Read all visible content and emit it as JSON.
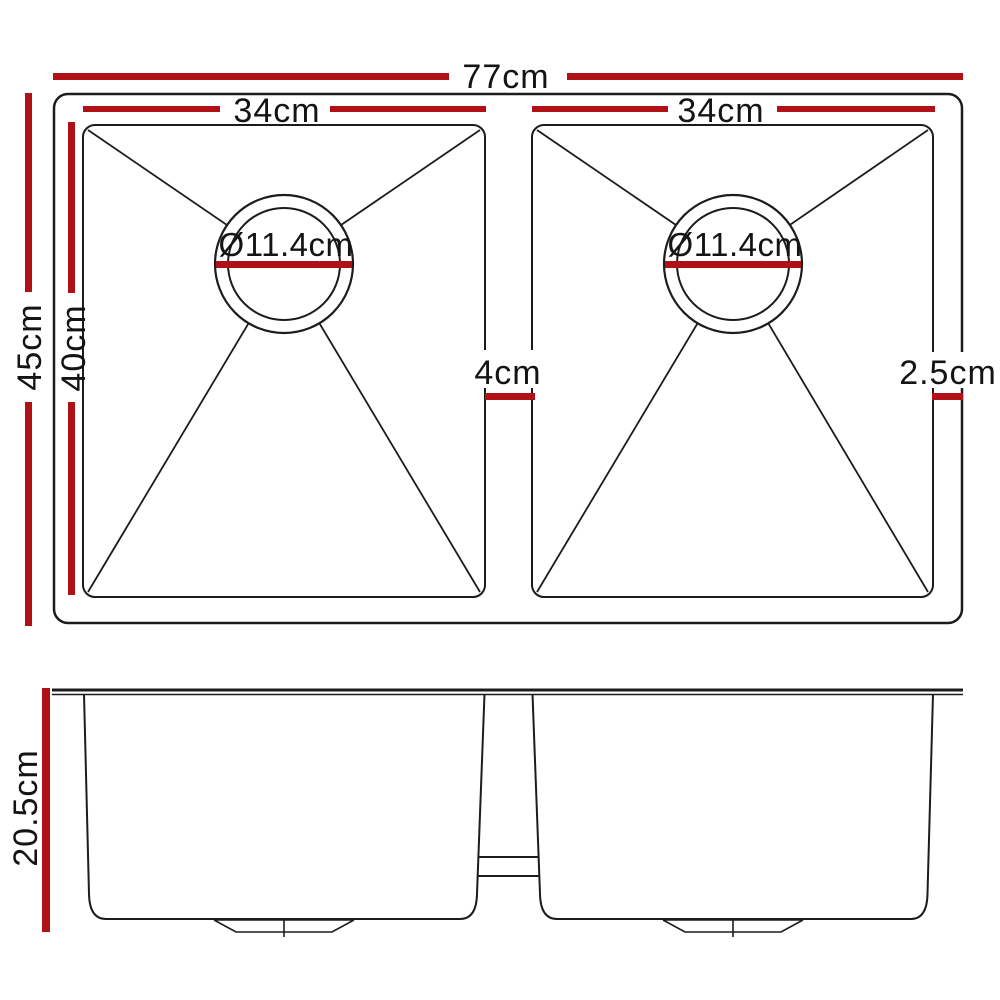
{
  "colors": {
    "dimension_red": "#b01116",
    "line_black": "#1c1c1c",
    "background": "#ffffff"
  },
  "top_view": {
    "view_name": "sink-top-view",
    "overall_width": "77cm",
    "overall_depth": "45cm",
    "bowl_inner_depth": "40cm",
    "left_bowl_width": "34cm",
    "right_bowl_width": "34cm",
    "left_drain_diameter": "Ø11.4cm",
    "right_drain_diameter": "Ø11.4cm",
    "center_divider_width": "4cm",
    "right_edge_width": "2.5cm"
  },
  "side_view": {
    "view_name": "sink-side-view",
    "bowl_height": "20.5cm"
  }
}
